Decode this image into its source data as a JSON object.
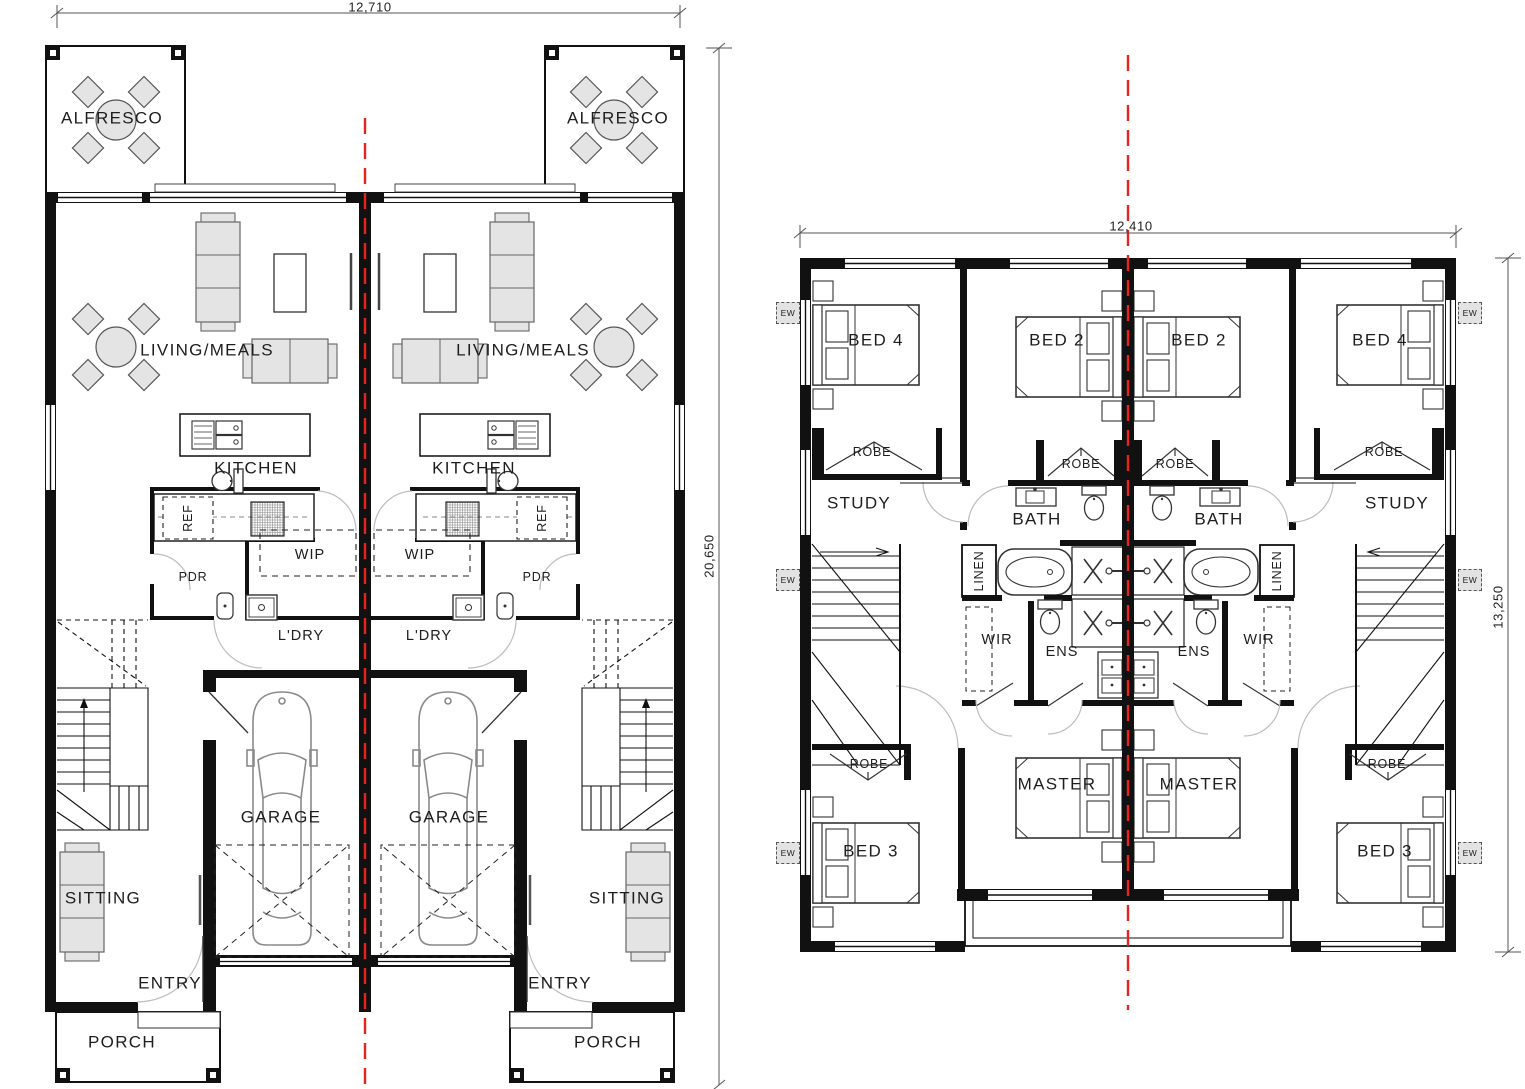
{
  "drawing": {
    "type": "duplex-floor-plan",
    "sheets": [
      "ground-floor",
      "first-floor"
    ]
  },
  "colors": {
    "wall": "#111111",
    "centerline_red": "#e8231e",
    "furniture_fill": "#e4e4e4",
    "furniture_stroke": "#666666",
    "door_arc": "#bdbdbd",
    "text": "#1d1d1d"
  },
  "ground_floor": {
    "dim_top": "12,710",
    "dim_right": "20,650",
    "labels": {
      "alfresco": "ALFRESCO",
      "living_meals": "LIVING/MEALS",
      "kitchen": "KITCHEN",
      "ref": "REF",
      "wip": "WIP",
      "pdr": "PDR",
      "laundry": "L'DRY",
      "garage": "GARAGE",
      "sitting": "SITTING",
      "entry": "ENTRY",
      "porch": "PORCH"
    }
  },
  "first_floor": {
    "dim_top": "12,410",
    "dim_right": "13,250",
    "labels": {
      "bed2": "BED 2",
      "bed3": "BED 3",
      "bed4": "BED 4",
      "master": "MASTER",
      "robe": "ROBE",
      "study": "STUDY",
      "bath": "BATH",
      "ens": "ENS",
      "wir": "WIR",
      "linen": "LINEN",
      "ew_tag": "EW"
    }
  }
}
